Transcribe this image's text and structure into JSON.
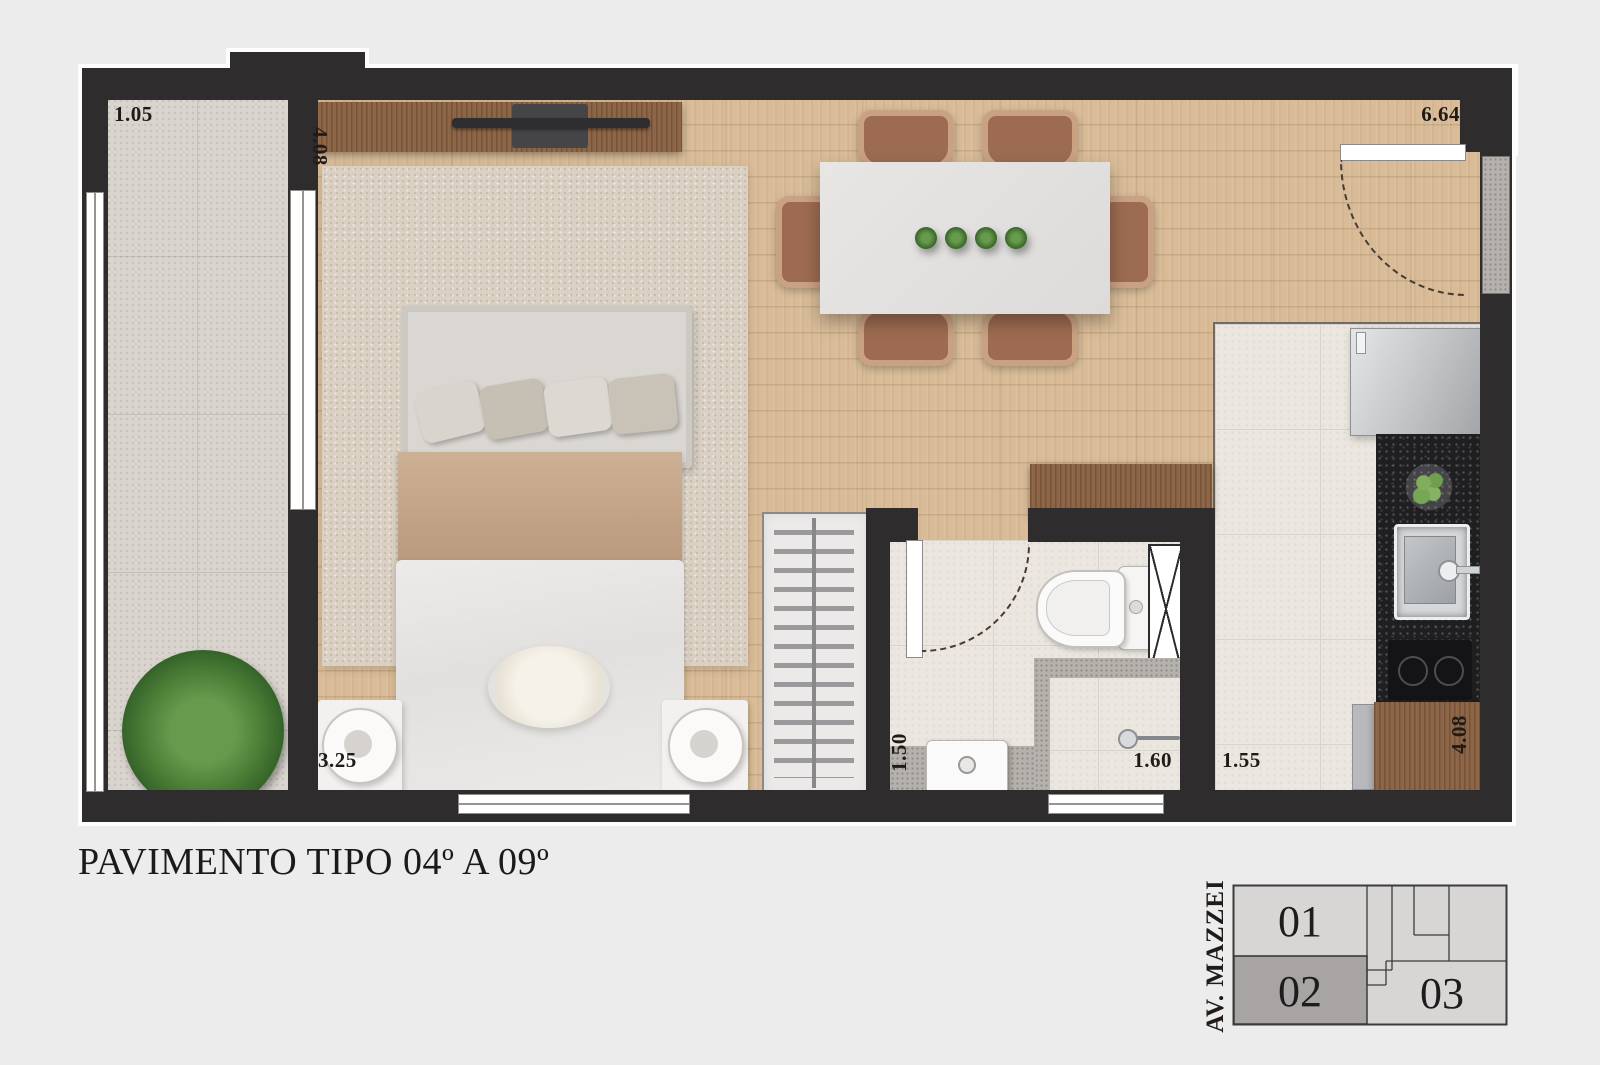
{
  "title": "PAVIMENTO TIPO 04º A 09º",
  "dimensions": {
    "balcony_width": "1.05",
    "bedroom_depth": "4.08",
    "bedroom_width": "3.25",
    "living_total": "6.64",
    "bathroom_width": "1.50",
    "bathroom_length": "1.60",
    "kitchen_width": "1.55",
    "kitchen_depth": "4.08"
  },
  "keyplan": {
    "street_label": "AV. MAZZEI",
    "units": [
      {
        "label": "01",
        "highlighted": false
      },
      {
        "label": "02",
        "highlighted": true
      },
      {
        "label": "03",
        "highlighted": false
      }
    ]
  },
  "colors": {
    "wall": "#2f2c2d",
    "wood_floor": "#d9bc97",
    "highlight_unit": "#a8a4a4",
    "background": "#ececec"
  }
}
